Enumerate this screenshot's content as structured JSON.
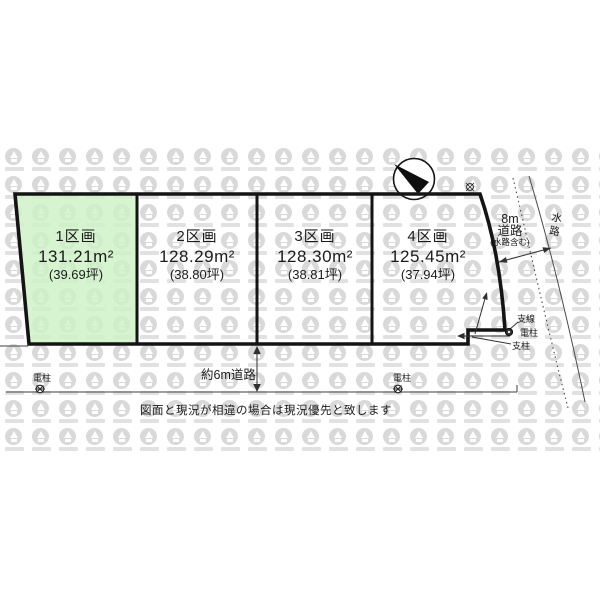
{
  "plots": [
    {
      "name": "1区画",
      "area_m2": "131.21m²",
      "area_tsubo": "(39.69坪)",
      "highlighted": true
    },
    {
      "name": "2区画",
      "area_m2": "128.29m²",
      "area_tsubo": "(38.80坪)",
      "highlighted": false
    },
    {
      "name": "3区画",
      "area_m2": "128.30m²",
      "area_tsubo": "(38.81坪)",
      "highlighted": false
    },
    {
      "name": "4区画",
      "area_m2": "125.45m²",
      "area_tsubo": "(37.94坪)",
      "highlighted": false
    }
  ],
  "annotations": {
    "south_road": "約6m道路",
    "east_road_line1": "8m",
    "east_road_line2": "道路",
    "east_road_note": "(水路含む)",
    "waterway": "水路",
    "pole_left": "電柱",
    "pole_right": "電柱",
    "pole_corner": "電柱",
    "guy_wire": "支線",
    "support_pole": "支柱",
    "disclaimer": "図面と現況が相違の場合は現況優先と致します"
  },
  "colors": {
    "highlight_green": "#cef2c7",
    "line_black": "#141414",
    "thin_line": "#3f3f3f",
    "watermark_gray": "#d9d9d9"
  }
}
